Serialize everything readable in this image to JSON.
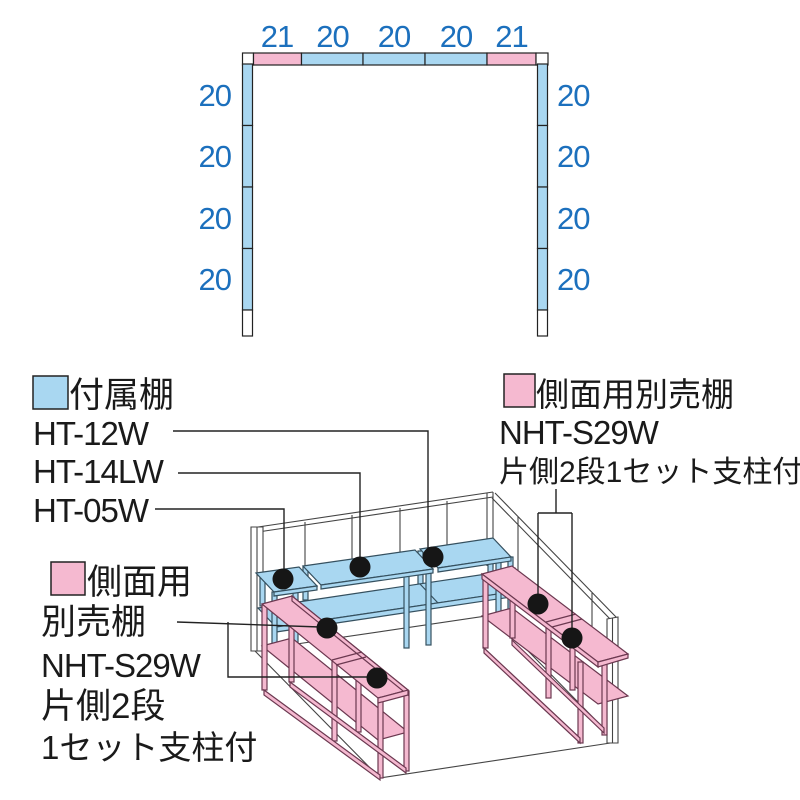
{
  "plan": {
    "top_dims": [
      "21",
      "20",
      "20",
      "20",
      "21"
    ],
    "side_dims_left": [
      "20",
      "20",
      "20",
      "20"
    ],
    "side_dims_right": [
      "20",
      "20",
      "20",
      "20"
    ]
  },
  "legends": {
    "attached": {
      "title": "付属棚",
      "model1": "HT-12W",
      "model2": "HT-14LW",
      "model3": "HT-05W"
    },
    "side_right": {
      "title": "側面用別売棚",
      "model": "NHT-S29W",
      "note": "片側2段1セット支柱付"
    },
    "side_left": {
      "line1": "側面用",
      "line2": "別売棚",
      "line3": "NHT-S29W",
      "line4": "片側2段",
      "line5": "1セット支柱付"
    }
  },
  "colors": {
    "shelf_blue": "#a9d7f1",
    "shelf_pink": "#f5b9d0",
    "dim_text_blue": "#1c70bd",
    "outline": "#444444",
    "marker_dot": "#161616"
  }
}
